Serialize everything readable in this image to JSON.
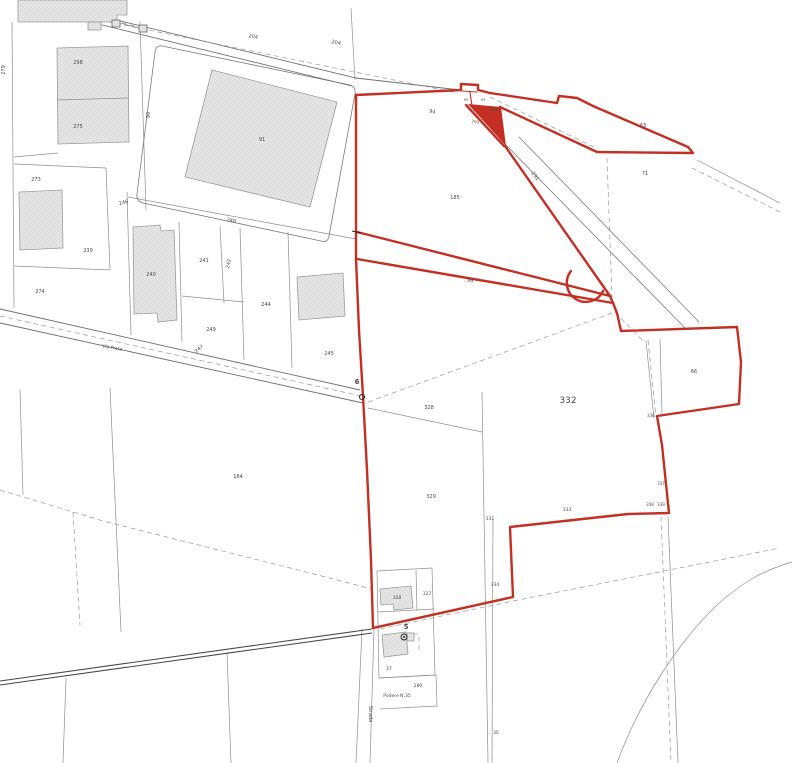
{
  "map": {
    "kind": "cadastral-parcel-plan",
    "colors": {
      "boundary_red": "#c52f23",
      "parcel_line": "#8f8f8f",
      "building_fill": "#e4e4e4",
      "background": "#ffffff"
    },
    "labels": [
      {
        "id": "parcel-298",
        "text": "298",
        "x": 78,
        "y": 64,
        "size": 5,
        "rot": 0,
        "bold": false
      },
      {
        "id": "parcel-275",
        "text": "275",
        "x": 78,
        "y": 128,
        "size": 5,
        "rot": 0,
        "bold": false
      },
      {
        "id": "parcel-279",
        "text": "279",
        "x": 5,
        "y": 70,
        "size": 5,
        "rot": -90,
        "bold": false
      },
      {
        "id": "parcel-273",
        "text": "273",
        "x": 36,
        "y": 181,
        "size": 5,
        "rot": 0,
        "bold": false
      },
      {
        "id": "parcel-274",
        "text": "274",
        "x": 40,
        "y": 293,
        "size": 5,
        "rot": 0,
        "bold": false
      },
      {
        "id": "parcel-239",
        "text": "239",
        "x": 88,
        "y": 252,
        "size": 5,
        "rot": 0,
        "bold": false
      },
      {
        "id": "parcel-246",
        "text": "246",
        "x": 124,
        "y": 204,
        "size": 5,
        "rot": -15,
        "bold": false
      },
      {
        "id": "parcel-240",
        "text": "240",
        "x": 151,
        "y": 276,
        "size": 5,
        "rot": 0,
        "bold": false
      },
      {
        "id": "parcel-241",
        "text": "241",
        "x": 204,
        "y": 262,
        "size": 5,
        "rot": 0,
        "bold": false
      },
      {
        "id": "parcel-242",
        "text": "242",
        "x": 230,
        "y": 264,
        "size": 5,
        "rot": -75,
        "bold": false
      },
      {
        "id": "parcel-248",
        "text": "248",
        "x": 231,
        "y": 222,
        "size": 5,
        "rot": 12,
        "bold": false
      },
      {
        "id": "parcel-249",
        "text": "249",
        "x": 211,
        "y": 331,
        "size": 5,
        "rot": 0,
        "bold": false
      },
      {
        "id": "parcel-247",
        "text": "247",
        "x": 200,
        "y": 350,
        "size": 5,
        "rot": -40,
        "bold": false
      },
      {
        "id": "parcel-244",
        "text": "244",
        "x": 266,
        "y": 306,
        "size": 5,
        "rot": 0,
        "bold": false
      },
      {
        "id": "parcel-245",
        "text": "245",
        "x": 329,
        "y": 355,
        "size": 5,
        "rot": 0,
        "bold": false
      },
      {
        "id": "road-204-a",
        "text": "204",
        "x": 253,
        "y": 38,
        "size": 5,
        "rot": 10,
        "bold": false
      },
      {
        "id": "road-204-b",
        "text": "204",
        "x": 336,
        "y": 44,
        "size": 5,
        "rot": 10,
        "bold": false
      },
      {
        "id": "parcel-90",
        "text": "90",
        "x": 150,
        "y": 115,
        "size": 5,
        "rot": -90,
        "bold": false
      },
      {
        "id": "building-91",
        "text": "91",
        "x": 262,
        "y": 141,
        "size": 5,
        "rot": 0,
        "bold": false
      },
      {
        "id": "road-94",
        "text": "94",
        "x": 432,
        "y": 113,
        "size": 5,
        "rot": 12,
        "bold": false
      },
      {
        "id": "parcel-95",
        "text": "95",
        "x": 466,
        "y": 101,
        "size": 3.5,
        "rot": 0,
        "bold": false
      },
      {
        "id": "parcel-93",
        "text": "93",
        "x": 483,
        "y": 101,
        "size": 3.5,
        "rot": 0,
        "bold": false
      },
      {
        "id": "parcel-209",
        "text": "209",
        "x": 494,
        "y": 111,
        "size": 4,
        "rot": 0,
        "bold": false
      },
      {
        "id": "parcel-290",
        "text": "290",
        "x": 475,
        "y": 123,
        "size": 4,
        "rot": 12,
        "bold": false
      },
      {
        "id": "parcel-63",
        "text": "63",
        "x": 643,
        "y": 127,
        "size": 5,
        "rot": 0,
        "bold": false
      },
      {
        "id": "parcel-71",
        "text": "71",
        "x": 645,
        "y": 175,
        "size": 5,
        "rot": 0,
        "bold": false
      },
      {
        "id": "parcel-185",
        "text": "185",
        "x": 455,
        "y": 199,
        "size": 5,
        "rot": 0,
        "bold": false
      },
      {
        "id": "road-291",
        "text": "291",
        "x": 534,
        "y": 177,
        "size": 5,
        "rot": 55,
        "bold": false
      },
      {
        "id": "parcel-98",
        "text": "98",
        "x": 470,
        "y": 282,
        "size": 5,
        "rot": 11,
        "bold": false
      },
      {
        "id": "parcel-332",
        "text": "332",
        "x": 568,
        "y": 403,
        "size": 9,
        "rot": 0,
        "bold": false
      },
      {
        "id": "parcel-328",
        "text": "328",
        "x": 429,
        "y": 409,
        "size": 5,
        "rot": 0,
        "bold": false
      },
      {
        "id": "parcel-329",
        "text": "329",
        "x": 431,
        "y": 498,
        "size": 5,
        "rot": 0,
        "bold": false
      },
      {
        "id": "parcel-331",
        "text": "331",
        "x": 490,
        "y": 520,
        "size": 4.5,
        "rot": 0,
        "bold": false
      },
      {
        "id": "parcel-333",
        "text": "333",
        "x": 567,
        "y": 511,
        "size": 4.5,
        "rot": 0,
        "bold": false
      },
      {
        "id": "parcel-334",
        "text": "334",
        "x": 495,
        "y": 586,
        "size": 4.5,
        "rot": 0,
        "bold": false
      },
      {
        "id": "parcel-66",
        "text": "66",
        "x": 694,
        "y": 373,
        "size": 5,
        "rot": 0,
        "bold": false
      },
      {
        "id": "parcel-336",
        "text": "336",
        "x": 651,
        "y": 417,
        "size": 4,
        "rot": 0,
        "bold": false
      },
      {
        "id": "parcel-337",
        "text": "337",
        "x": 661,
        "y": 485,
        "size": 4,
        "rot": 0,
        "bold": false
      },
      {
        "id": "parcel-338",
        "text": "338",
        "x": 650,
        "y": 506,
        "size": 4,
        "rot": 0,
        "bold": false
      },
      {
        "id": "parcel-339",
        "text": "339",
        "x": 661,
        "y": 506,
        "size": 4,
        "rot": 0,
        "bold": false
      },
      {
        "id": "parcel-184",
        "text": "184",
        "x": 238,
        "y": 478,
        "size": 5,
        "rot": 0,
        "bold": false
      },
      {
        "id": "building-328",
        "text": "328",
        "x": 397,
        "y": 599,
        "size": 4.5,
        "rot": 0,
        "bold": false
      },
      {
        "id": "parcel-327",
        "text": "327",
        "x": 427,
        "y": 595,
        "size": 4.5,
        "rot": 0,
        "bold": false
      },
      {
        "id": "parcel-27",
        "text": "27",
        "x": 389,
        "y": 670,
        "size": 4.5,
        "rot": 0,
        "bold": false
      },
      {
        "id": "parcel-280",
        "text": "280",
        "x": 418,
        "y": 687,
        "size": 4.5,
        "rot": 0,
        "bold": false
      },
      {
        "id": "podere-label",
        "text": "Podere N.35",
        "x": 397,
        "y": 697,
        "size": 4.5,
        "rot": 0,
        "bold": false
      },
      {
        "id": "strada-label",
        "text": "Strada",
        "x": 369,
        "y": 714,
        "size": 5,
        "rot": 90,
        "bold": false
      },
      {
        "id": "parcel-35",
        "text": "35",
        "x": 496,
        "y": 734,
        "size": 4.5,
        "rot": 0,
        "bold": false
      },
      {
        "id": "via-label",
        "text": "Via Prata",
        "x": 112,
        "y": 349,
        "size": 4.5,
        "rot": 10,
        "bold": false
      },
      {
        "id": "survey-point-6-label",
        "text": "6",
        "x": 357,
        "y": 384,
        "size": 7,
        "rot": 0,
        "bold": true
      },
      {
        "id": "survey-point-5-label",
        "text": "5",
        "x": 406,
        "y": 629,
        "size": 7,
        "rot": 0,
        "bold": true
      }
    ]
  }
}
